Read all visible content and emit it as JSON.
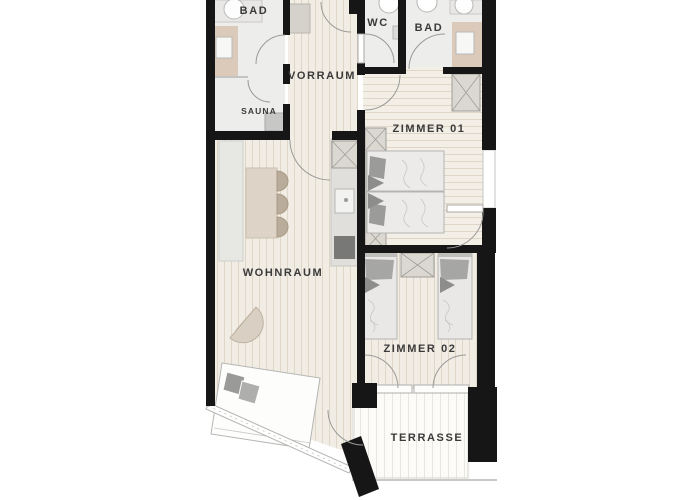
{
  "title": "Apartment floor plan",
  "rooms": {
    "bathroom_top_left": {
      "label": "BAD"
    },
    "wc": {
      "label": "WC"
    },
    "bathroom_top_right": {
      "label": "BAD"
    },
    "hallway": {
      "label": "VORRAUM"
    },
    "sauna": {
      "label": "SAUNA"
    },
    "bedroom_1": {
      "label": "ZIMMER 01"
    },
    "living_room": {
      "label": "WOHNRAUM"
    },
    "bedroom_2": {
      "label": "ZIMMER 02"
    },
    "terrace": {
      "label": "TERRASSE"
    }
  },
  "colors": {
    "wall": "#161616",
    "wood_floor": "#f2ede4",
    "wood_stripe": "#ded6c7",
    "tile_floor": "#ededeb",
    "terrace_floor": "#fcfbf8",
    "shower_tan": "#dbc9ba",
    "furniture_gray": "#dbd8d2",
    "label_text": "#3a3a3a"
  }
}
